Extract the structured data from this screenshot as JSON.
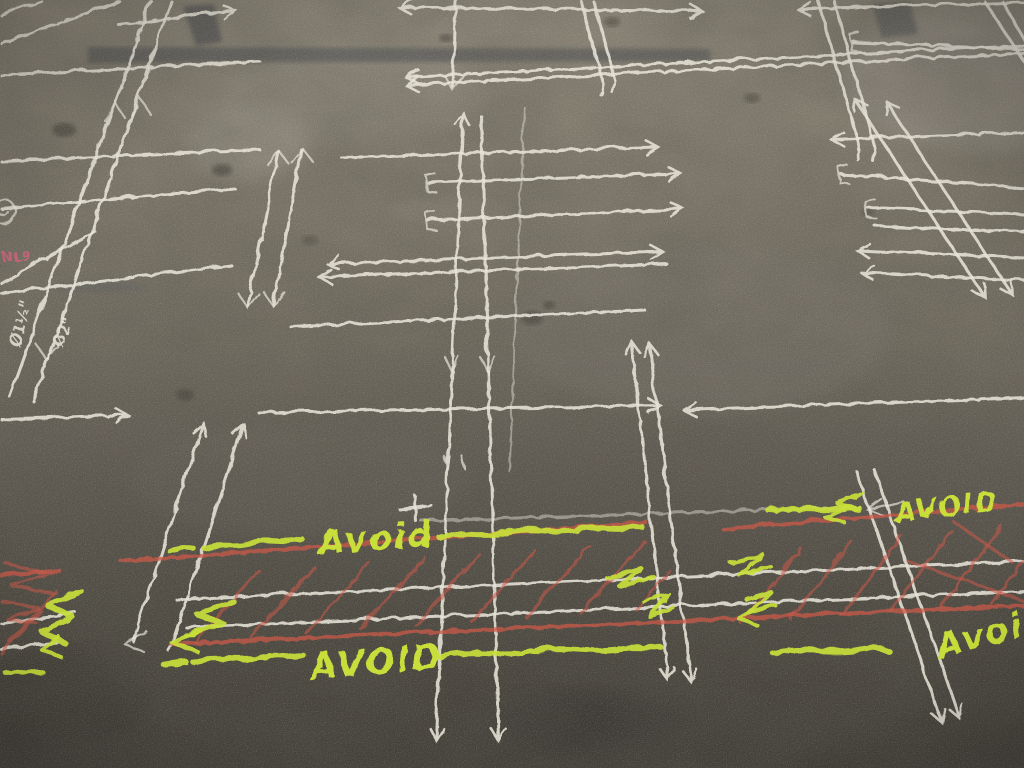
{
  "scene": {
    "kind": "photograph",
    "subject": "concrete floor with construction chalk layout markings"
  },
  "labels": {
    "avoid_center_top": "Avoid",
    "avoid_center_bottom": "AVOID",
    "avoid_right_top": "AVOID",
    "avoid_right_bottom": "Avoid",
    "pink_note": "NL9",
    "pipe_dia_1": "Ø1½\"",
    "pipe_dia_2": "Ø2\""
  },
  "colors": {
    "chalk_white": "#e7e4d8",
    "chalk_red": "#cb5a4b",
    "chalk_yellow": "#c8df3a",
    "chalk_pink": "#d4647f",
    "floor_light": "#8d8779",
    "floor_mid": "#6f6a5e",
    "floor_dark": "#403d36"
  }
}
